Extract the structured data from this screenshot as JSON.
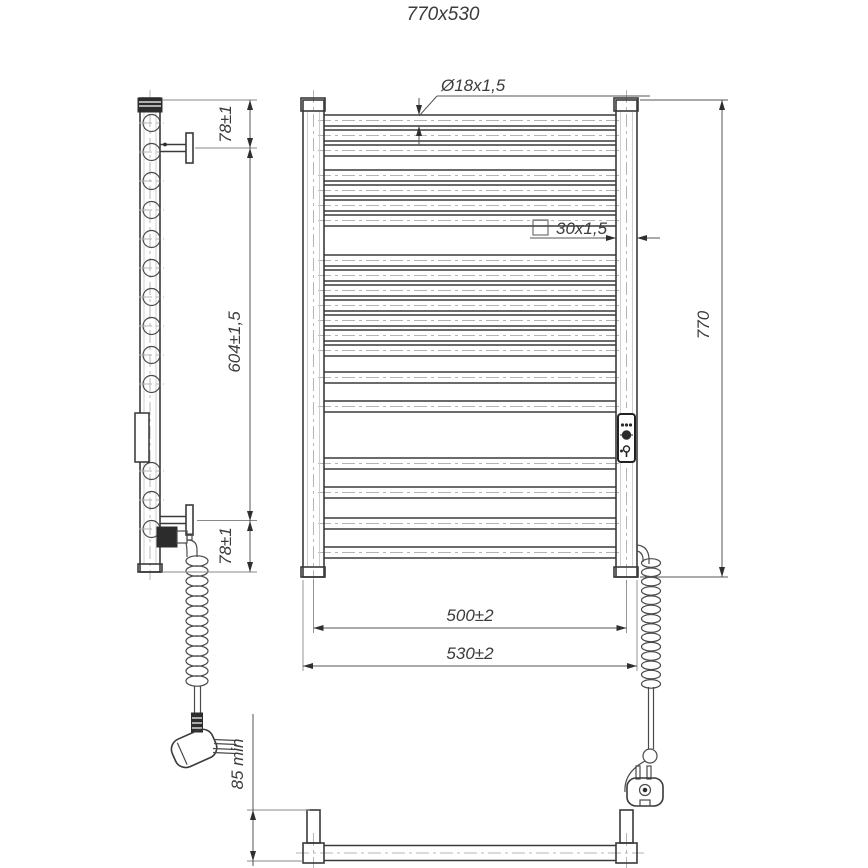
{
  "title": "770x530",
  "dimensions": {
    "tube_diameter": "Ø18x1,5",
    "post_profile": "30x1,5",
    "overall_height": "770",
    "bracket_span": "604±1,5",
    "top_bracket_offset": "78±1",
    "bottom_bracket_offset": "78±1",
    "rung_span": "500±2",
    "overall_width": "530±2",
    "wall_clearance": "85 min"
  },
  "colors": {
    "line": "#3a3a3a",
    "centerline": "#b5b5b5",
    "background": "#ffffff"
  }
}
